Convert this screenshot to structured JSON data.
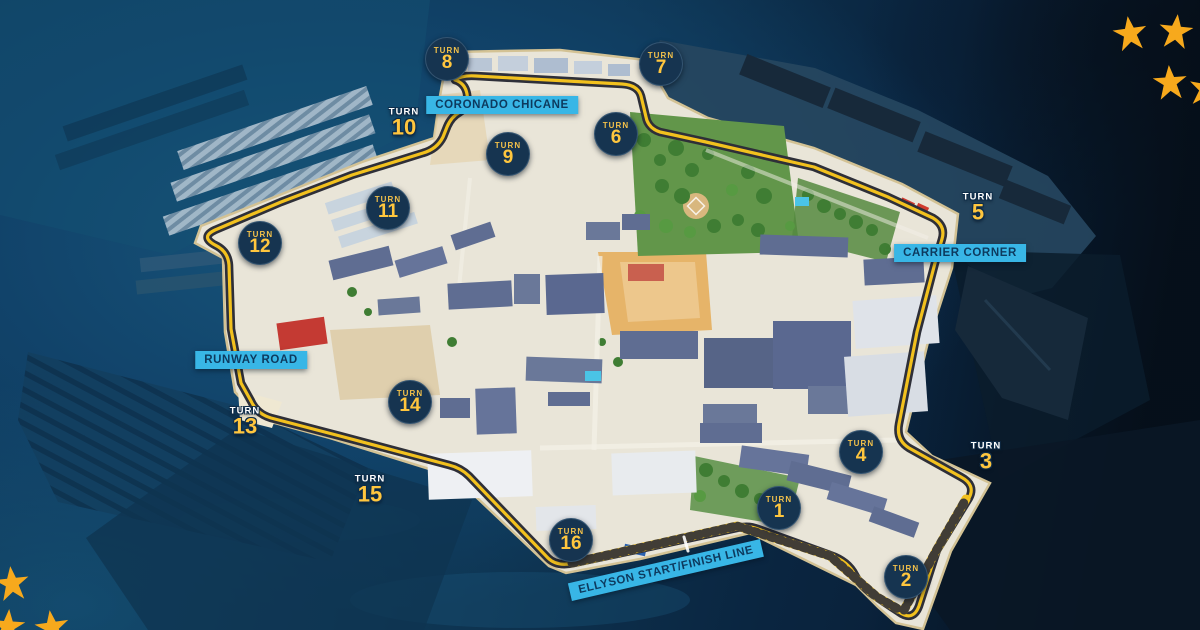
{
  "map": {
    "turn_word": "TURN",
    "turns": [
      {
        "number": "1",
        "style": "circle"
      },
      {
        "number": "2",
        "style": "circle"
      },
      {
        "number": "3",
        "style": "plain"
      },
      {
        "number": "4",
        "style": "circle"
      },
      {
        "number": "5",
        "style": "plain"
      },
      {
        "number": "6",
        "style": "circle"
      },
      {
        "number": "7",
        "style": "circle"
      },
      {
        "number": "8",
        "style": "circle"
      },
      {
        "number": "9",
        "style": "circle"
      },
      {
        "number": "10",
        "style": "plain"
      },
      {
        "number": "11",
        "style": "circle"
      },
      {
        "number": "12",
        "style": "circle"
      },
      {
        "number": "13",
        "style": "plain"
      },
      {
        "number": "14",
        "style": "circle"
      },
      {
        "number": "15",
        "style": "plain"
      },
      {
        "number": "16",
        "style": "circle"
      }
    ],
    "labels": {
      "coronado_chicane": "CORONADO CHICANE",
      "carrier_corner": "CARRIER CORNER",
      "runway_road": "RUNWAY ROAD",
      "start_finish": "ELLYSON START/FINISH LINE"
    }
  },
  "colors": {
    "track_yellow": "#f2c11e",
    "track_casing": "#2e2f38",
    "marker_navy": "#163450",
    "marker_yellow": "#ffc63e",
    "label_cyan": "#38b6e6",
    "label_text": "#0d3a5e",
    "star_gold": "#f7a91c",
    "island_ground": "#e9e5d8",
    "ocean_deep": "#0a1f33"
  }
}
